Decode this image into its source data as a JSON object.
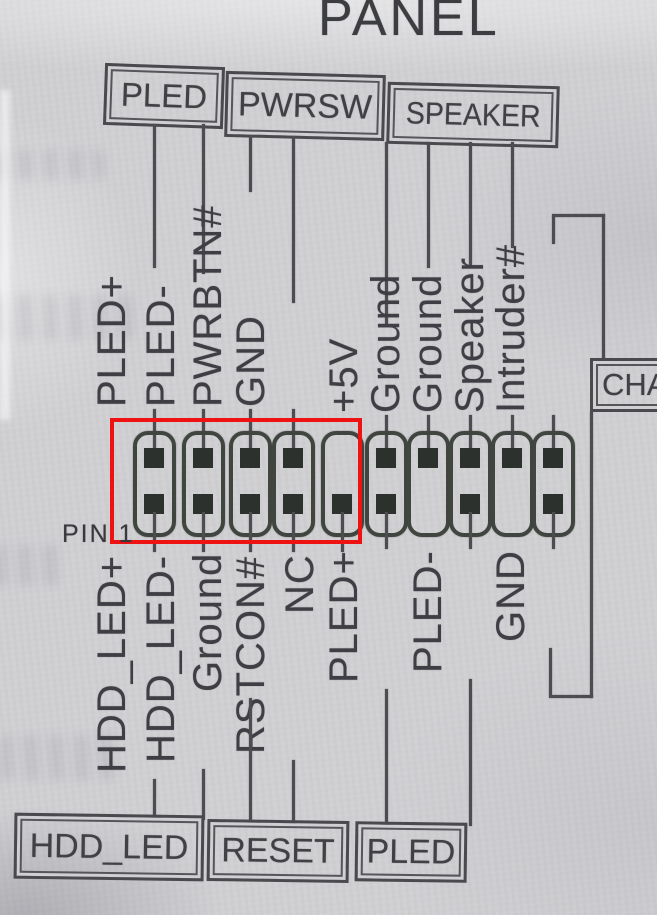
{
  "title": "PANEL",
  "colors": {
    "paper": "#d0cfd2",
    "ink": "#4a4a4e",
    "pin_dark": "#2d312d",
    "highlight_red": "#ee1212"
  },
  "top_boxes": [
    {
      "label": "PLED"
    },
    {
      "label": "PWRSW"
    },
    {
      "label": "SPEAKER"
    }
  ],
  "chassis_box": {
    "label": "CHA"
  },
  "pin1_label": "PIN 1",
  "header": {
    "top_labels": [
      "PLED+",
      "PLED-",
      "PWRBTN#",
      "GND",
      "",
      "+5V",
      "Ground",
      "Ground",
      "Speaker",
      "Intruder#"
    ],
    "bottom_labels": [
      "HDD_LED+",
      "HDD_LED-",
      "Ground",
      "RSTCON#",
      "NC",
      "PLED+",
      "",
      "PLED-",
      "",
      "GND"
    ]
  },
  "bottom_boxes": [
    {
      "label": "HDD_LED"
    },
    {
      "label": "RESET"
    },
    {
      "label": "PLED"
    }
  ]
}
